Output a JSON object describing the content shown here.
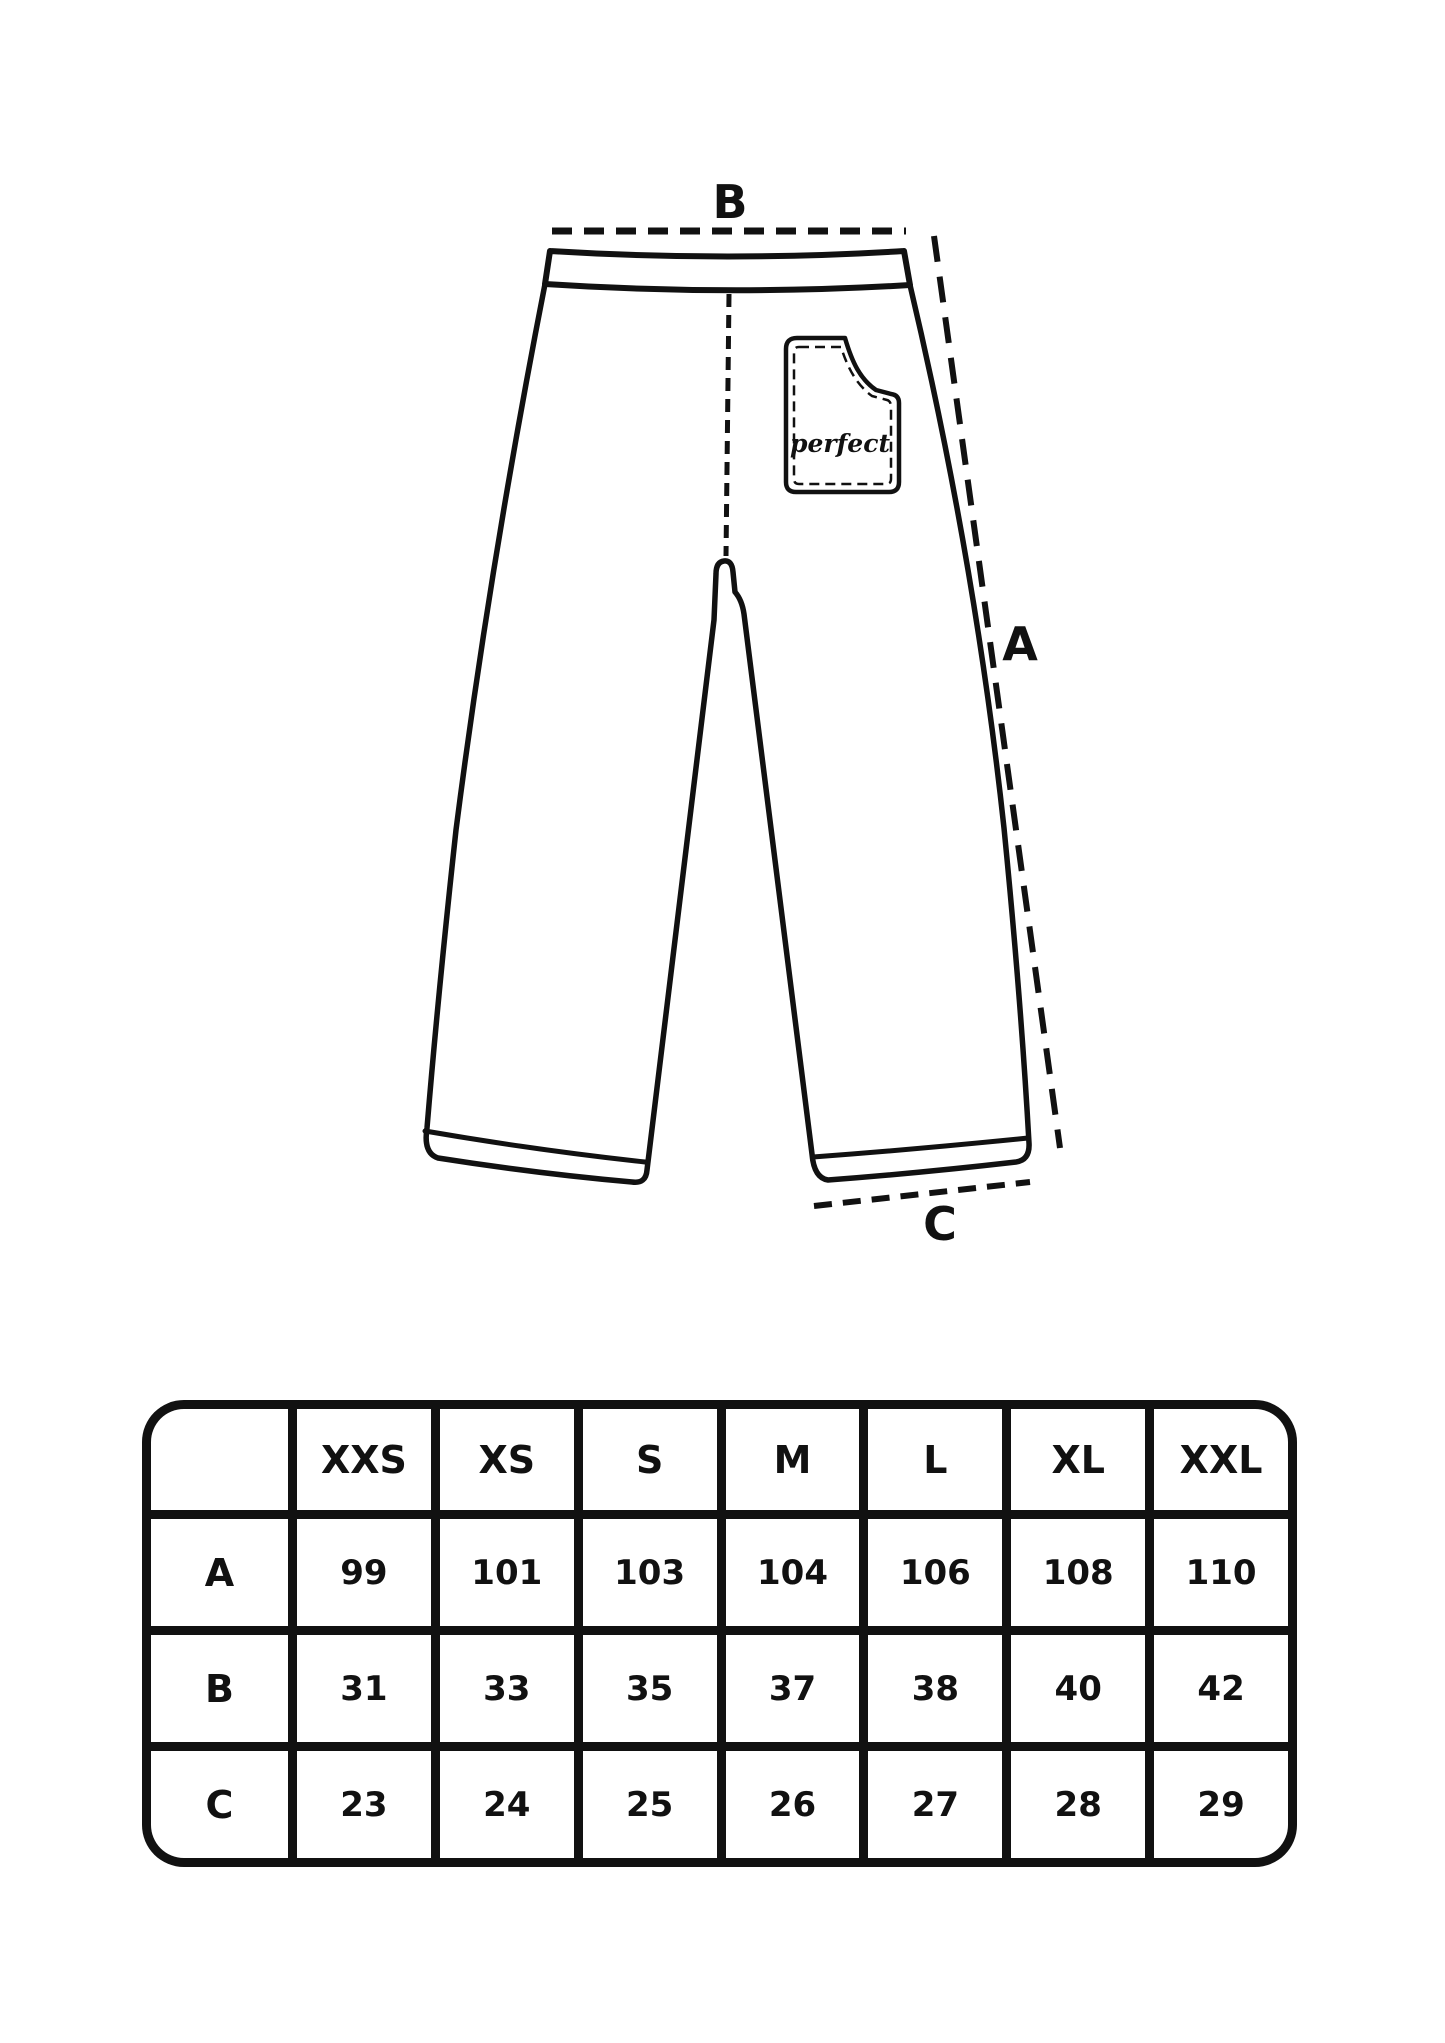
{
  "page": {
    "background": "#ffffff",
    "ink": "#111111"
  },
  "diagram": {
    "labels": {
      "a": "A",
      "b": "B",
      "c": "C"
    },
    "pocket_text": "perfect"
  },
  "size_table": {
    "corner_label": "",
    "columns": [
      "XXS",
      "XS",
      "S",
      "M",
      "L",
      "XL",
      "XXL"
    ],
    "rows": [
      {
        "label": "A",
        "values": [
          99,
          101,
          103,
          104,
          106,
          108,
          110
        ]
      },
      {
        "label": "B",
        "values": [
          31,
          33,
          35,
          37,
          38,
          40,
          42
        ]
      },
      {
        "label": "C",
        "values": [
          23,
          24,
          25,
          26,
          27,
          28,
          29
        ]
      }
    ]
  }
}
